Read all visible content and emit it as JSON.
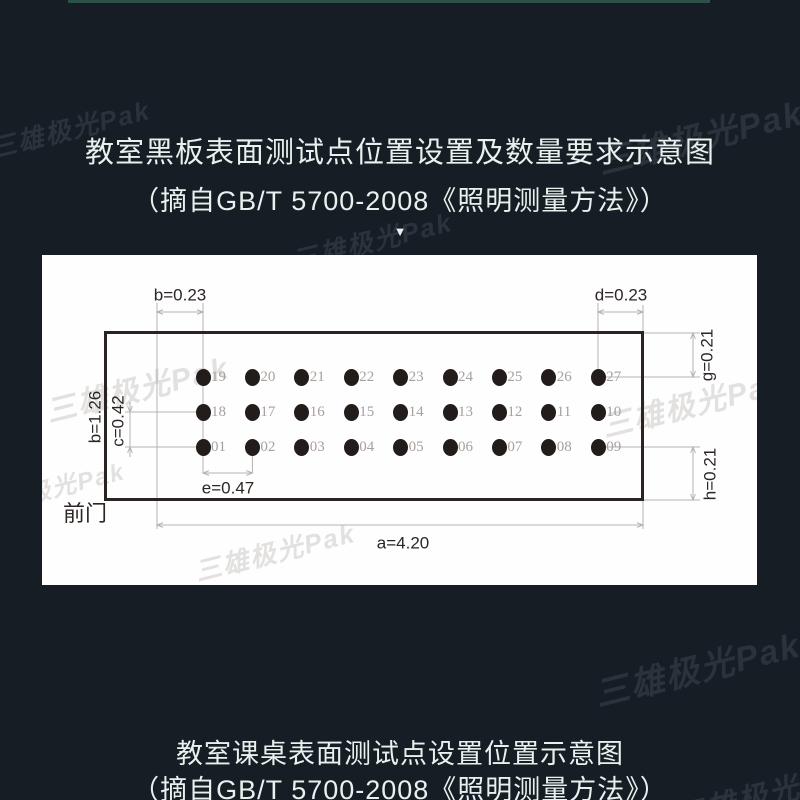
{
  "watermark": {
    "text": "三雄极光Pak"
  },
  "top_block": {
    "title": "教室黑板表面测试点位置设置及数量要求示意图",
    "subtitle": "（摘自GB/T 5700-2008《照明测量方法》）",
    "arrow": "▼"
  },
  "diagram": {
    "front_door_label": "前门",
    "dimensions": {
      "b_top": "b=0.23",
      "d_top": "d=0.23",
      "g_right": "g=0.21",
      "h_right": "h=0.21",
      "b_left": "b=1.26",
      "c_left": "c=0.42",
      "e_bottom": "e=0.47",
      "a_bottom": "a=4.20"
    },
    "rows": [
      [
        "19",
        "20",
        "21",
        "22",
        "23",
        "24",
        "25",
        "26",
        "27"
      ],
      [
        "18",
        "17",
        "16",
        "15",
        "14",
        "13",
        "12",
        "11",
        "10"
      ],
      [
        "01",
        "02",
        "03",
        "04",
        "05",
        "06",
        "07",
        "08",
        "09"
      ]
    ]
  },
  "bottom_block": {
    "title": "教室课桌表面测试点设置位置示意图",
    "subtitle": "（摘自GB/T 5700-2008《照明测量方法》）"
  },
  "colors": {
    "background": "#161d25",
    "accent_line": "#2d5146",
    "panel": "#fefefe",
    "heading_text": "#e8f1ed",
    "diagram_ink": "#2a2322",
    "dimension_line": "#b6b3b1",
    "point_label": "#a5a19f"
  }
}
